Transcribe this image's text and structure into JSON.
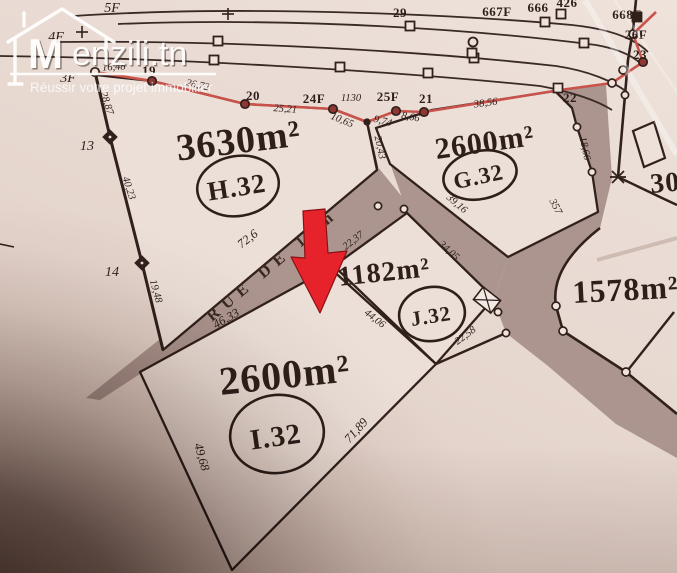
{
  "map": {
    "street_name": "RUE DE 10m",
    "plots": {
      "h32": {
        "area": "3630m²",
        "id": "H.32"
      },
      "g32": {
        "area": "2600m²",
        "id": "G.32"
      },
      "j32": {
        "area": "1182m²",
        "id": "J.32"
      },
      "i32": {
        "area": "2600m²",
        "id": "I.32"
      },
      "east": {
        "area": "1578m²"
      },
      "northeast": {
        "area_partial": "30"
      }
    },
    "labels": [
      {
        "t": "5F",
        "x": 112,
        "y": 12,
        "r": 0,
        "s": "f"
      },
      {
        "t": "4F",
        "x": 56,
        "y": 41,
        "r": 0,
        "s": "f"
      },
      {
        "t": "3F",
        "x": 68,
        "y": 82,
        "r": 0,
        "s": "f"
      },
      {
        "t": "13",
        "x": 87,
        "y": 150,
        "r": 0,
        "s": "f"
      },
      {
        "t": "14",
        "x": 112,
        "y": 276,
        "r": 0,
        "s": "f"
      },
      {
        "t": "29",
        "x": 400,
        "y": 17,
        "r": 0,
        "s": "b"
      },
      {
        "t": "667F",
        "x": 497,
        "y": 16,
        "r": 0,
        "s": "b"
      },
      {
        "t": "666",
        "x": 538,
        "y": 12,
        "r": 0,
        "s": "b"
      },
      {
        "t": "426",
        "x": 567,
        "y": 7,
        "r": 0,
        "s": "b"
      },
      {
        "t": "668F",
        "x": 627,
        "y": 19,
        "r": 0,
        "s": "b"
      },
      {
        "t": "26F",
        "x": 636,
        "y": 39,
        "r": 0,
        "s": "b"
      },
      {
        "t": "23",
        "x": 640,
        "y": 59,
        "r": 0,
        "s": "b"
      },
      {
        "t": "22",
        "x": 570,
        "y": 102,
        "r": 0,
        "s": "b"
      },
      {
        "t": "19",
        "x": 149,
        "y": 75,
        "r": 0,
        "s": "b"
      },
      {
        "t": "20",
        "x": 253,
        "y": 100,
        "r": 0,
        "s": "b"
      },
      {
        "t": "24F",
        "x": 314,
        "y": 103,
        "r": 0,
        "s": "b"
      },
      {
        "t": "25F",
        "x": 388,
        "y": 101,
        "r": 0,
        "s": "b"
      },
      {
        "t": "21",
        "x": 426,
        "y": 103,
        "r": 0,
        "s": "b"
      },
      {
        "t": "1130",
        "x": 351,
        "y": 101,
        "r": 0,
        "s": "i"
      },
      {
        "t": "16,48",
        "x": 114,
        "y": 70,
        "r": -3,
        "s": "i"
      },
      {
        "t": "26,72",
        "x": 197,
        "y": 88,
        "r": 12,
        "s": "i"
      },
      {
        "t": "25,21",
        "x": 285,
        "y": 112,
        "r": 4,
        "s": "i"
      },
      {
        "t": "10,65",
        "x": 341,
        "y": 123,
        "r": 22,
        "s": "i"
      },
      {
        "t": "9,74",
        "x": 382,
        "y": 124,
        "r": 15,
        "s": "i"
      },
      {
        "t": "8,66",
        "x": 410,
        "y": 120,
        "r": 10,
        "s": "i"
      },
      {
        "t": "38,56",
        "x": 486,
        "y": 106,
        "r": -8,
        "s": "i"
      },
      {
        "t": "28,87",
        "x": 104,
        "y": 104,
        "r": 72,
        "s": "i"
      },
      {
        "t": "40,23",
        "x": 126,
        "y": 189,
        "r": 72,
        "s": "i"
      },
      {
        "t": "19,48",
        "x": 153,
        "y": 292,
        "r": 74,
        "s": "i"
      },
      {
        "t": "20,43",
        "x": 377,
        "y": 148,
        "r": 78,
        "s": "i"
      },
      {
        "t": "72,6",
        "x": 250,
        "y": 242,
        "r": -38,
        "s": "i2"
      },
      {
        "t": "46,33",
        "x": 228,
        "y": 322,
        "r": -30,
        "s": "i2"
      },
      {
        "t": "22,37",
        "x": 355,
        "y": 243,
        "r": -38,
        "s": "i"
      },
      {
        "t": "34,05",
        "x": 447,
        "y": 253,
        "r": 42,
        "s": "i"
      },
      {
        "t": "44,06",
        "x": 373,
        "y": 321,
        "r": 38,
        "s": "i"
      },
      {
        "t": "22,58",
        "x": 467,
        "y": 338,
        "r": -36,
        "s": "i"
      },
      {
        "t": "39,16",
        "x": 455,
        "y": 206,
        "r": 40,
        "s": "i"
      },
      {
        "t": "18,66",
        "x": 582,
        "y": 149,
        "r": 78,
        "s": "i"
      },
      {
        "t": "357",
        "x": 553,
        "y": 208,
        "r": 62,
        "s": "i"
      },
      {
        "t": "71,89",
        "x": 359,
        "y": 433,
        "r": -48,
        "s": "i2"
      },
      {
        "t": "49,68",
        "x": 198,
        "y": 458,
        "r": 74,
        "s": "i2"
      }
    ]
  },
  "watermark": {
    "monogram": "M",
    "brand": "enzili.tn",
    "tagline": "Réussir votre projet immobilier"
  },
  "colors": {
    "paper": "#e9dbd3",
    "plot_fill": "#ebdfd8",
    "street": "#ab958e",
    "line": "#31201c",
    "red_boundary": "#c9534b",
    "red_point": "#8e3733",
    "arrow": "#e6232b",
    "logo": "#ffffff"
  }
}
